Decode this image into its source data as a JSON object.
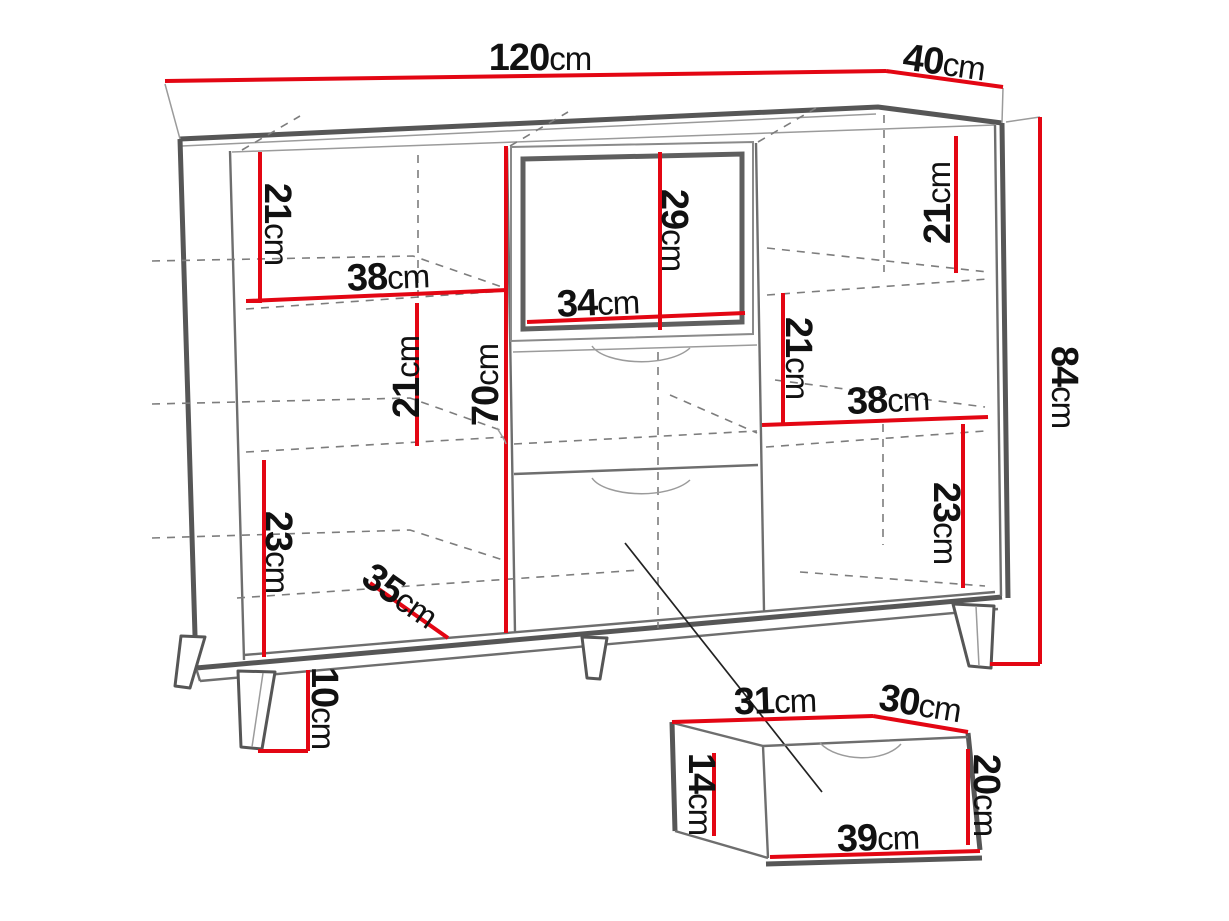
{
  "diagram_type": "furniture dimension drawing (sideboard with drawer detail)",
  "unit": "cm",
  "colors": {
    "background": "#ffffff",
    "dimension_red": "#e30613",
    "outline_dark": "#565656",
    "outline_mid": "#6e6e6e",
    "outline_light": "#9b9b9b",
    "hidden_line": "#7d7d7d",
    "label_text": "#111111",
    "leader_line": "#222222"
  },
  "cabinet": {
    "width": {
      "value": "120",
      "unit": "cm"
    },
    "depth": {
      "value": "40",
      "unit": "cm"
    },
    "height": {
      "value": "84",
      "unit": "cm"
    },
    "interior_height": {
      "value": "70",
      "unit": "cm"
    },
    "left_section": {
      "top_shelf_height": {
        "value": "21",
        "unit": "cm"
      },
      "shelf_width": {
        "value": "38",
        "unit": "cm"
      },
      "middle_shelf_height": {
        "value": "21",
        "unit": "cm"
      },
      "bottom_shelf_height": {
        "value": "23",
        "unit": "cm"
      }
    },
    "middle_section": {
      "niche_height": {
        "value": "29",
        "unit": "cm"
      },
      "niche_width": {
        "value": "34",
        "unit": "cm"
      }
    },
    "right_section": {
      "top_shelf_height": {
        "value": "21",
        "unit": "cm"
      },
      "middle_shelf_height": {
        "value": "21",
        "unit": "cm"
      },
      "shelf_width": {
        "value": "38",
        "unit": "cm"
      },
      "bottom_shelf_height": {
        "value": "23",
        "unit": "cm"
      }
    },
    "base": {
      "bottom_depth": {
        "value": "35",
        "unit": "cm"
      },
      "leg_height": {
        "value": "10",
        "unit": "cm"
      }
    }
  },
  "drawer_detail": {
    "top_width": {
      "value": "31",
      "unit": "cm"
    },
    "depth": {
      "value": "30",
      "unit": "cm"
    },
    "side_height": {
      "value": "14",
      "unit": "cm"
    },
    "front_height": {
      "value": "20",
      "unit": "cm"
    },
    "front_width": {
      "value": "39",
      "unit": "cm"
    }
  }
}
